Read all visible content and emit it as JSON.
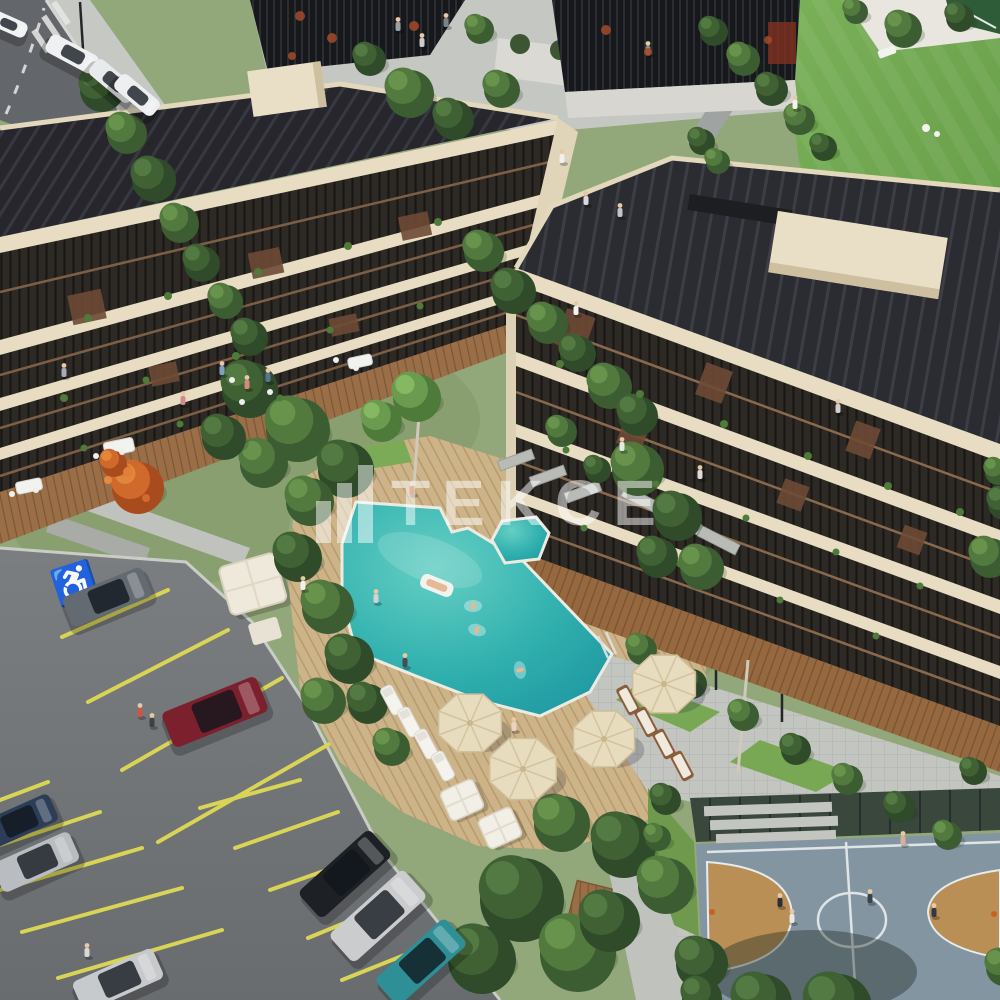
{
  "scene": {
    "type": "aerial-architectural-render",
    "subject": "residential complex with courtyard pool, parking lot and basketball court",
    "parking": {
      "accessible_symbol": "♿"
    }
  },
  "watermark": {
    "text": "TEKCE",
    "icon": "building-bars-logo",
    "color": "#ffffff",
    "opacity": 0.5
  },
  "palette": {
    "lawn": "#74a650",
    "garden": "#93a87a",
    "pool_main": "#35b5b2",
    "cream_band": "#e8ddc2",
    "roof_dark": "#26262c",
    "asphalt": "#77797c",
    "road": "#63666a",
    "deck_tan": "#cdb488",
    "terrace_wood": "#9a6f48",
    "court_blue": "#8495a2",
    "court_key_tan": "#b98f55",
    "stall_yellow": "#d9d455",
    "path_gray": "#c0c2bd",
    "tree_dark": "#3f6134",
    "tree_mid": "#527a3e",
    "tree_orange": "#cf6a2c"
  },
  "objects": {
    "trees": [
      [
        100,
        88,
        22,
        "d"
      ],
      [
        125,
        132,
        20,
        "m"
      ],
      [
        152,
        178,
        22,
        "d"
      ],
      [
        178,
        222,
        19,
        "m"
      ],
      [
        200,
        262,
        18,
        "d"
      ],
      [
        224,
        300,
        17,
        "m"
      ],
      [
        248,
        336,
        18,
        "d"
      ],
      [
        408,
        92,
        24,
        "m"
      ],
      [
        452,
        118,
        20,
        "d"
      ],
      [
        500,
        88,
        18,
        "m"
      ],
      [
        368,
        58,
        16,
        "d"
      ],
      [
        478,
        28,
        14,
        "m"
      ],
      [
        712,
        30,
        14,
        "d"
      ],
      [
        742,
        58,
        16,
        "m"
      ],
      [
        770,
        88,
        16,
        "d"
      ],
      [
        798,
        118,
        15,
        "m"
      ],
      [
        822,
        146,
        13,
        "d"
      ],
      [
        902,
        28,
        18,
        "m"
      ],
      [
        958,
        16,
        14,
        "d"
      ],
      [
        854,
        10,
        12,
        "m"
      ],
      [
        700,
        140,
        13,
        "d"
      ],
      [
        716,
        160,
        12,
        "m"
      ],
      [
        482,
        250,
        20,
        "m"
      ],
      [
        512,
        290,
        22,
        "d"
      ],
      [
        546,
        322,
        20,
        "m"
      ],
      [
        576,
        352,
        18,
        "d"
      ],
      [
        608,
        385,
        22,
        "m"
      ],
      [
        636,
        414,
        20,
        "d"
      ],
      [
        248,
        388,
        28,
        "d"
      ],
      [
        296,
        428,
        32,
        "m"
      ],
      [
        344,
        468,
        28,
        "d"
      ],
      [
        262,
        462,
        24,
        "m"
      ],
      [
        222,
        436,
        22,
        "d"
      ],
      [
        380,
        420,
        20,
        "l"
      ],
      [
        415,
        396,
        24,
        "l"
      ],
      [
        308,
        500,
        24,
        "m"
      ],
      [
        636,
        468,
        26,
        "m"
      ],
      [
        676,
        515,
        24,
        "d"
      ],
      [
        700,
        566,
        22,
        "m"
      ],
      [
        656,
        556,
        20,
        "d"
      ],
      [
        560,
        430,
        15,
        "m"
      ],
      [
        596,
        468,
        13,
        "d"
      ],
      [
        296,
        556,
        24,
        "d"
      ],
      [
        326,
        606,
        26,
        "m"
      ],
      [
        348,
        658,
        24,
        "d"
      ],
      [
        322,
        700,
        22,
        "m"
      ],
      [
        366,
        702,
        20,
        "d"
      ],
      [
        390,
        746,
        18,
        "m"
      ],
      [
        136,
        486,
        26,
        "o"
      ],
      [
        112,
        462,
        13,
        "o"
      ],
      [
        520,
        898,
        42,
        "d"
      ],
      [
        576,
        952,
        38,
        "m"
      ],
      [
        622,
        844,
        32,
        "d"
      ],
      [
        560,
        822,
        28,
        "m"
      ],
      [
        480,
        958,
        34,
        "d"
      ],
      [
        664,
        884,
        28,
        "m"
      ],
      [
        608,
        920,
        30,
        "d"
      ],
      [
        700,
        962,
        26,
        "d"
      ],
      [
        760,
        1002,
        30,
        "d"
      ],
      [
        836,
        1006,
        34,
        "d"
      ],
      [
        640,
        648,
        15,
        "m"
      ],
      [
        690,
        682,
        15,
        "d"
      ],
      [
        742,
        714,
        15,
        "m"
      ],
      [
        794,
        748,
        15,
        "d"
      ],
      [
        846,
        778,
        15,
        "m"
      ],
      [
        898,
        806,
        15,
        "d"
      ],
      [
        946,
        834,
        14,
        "m"
      ],
      [
        988,
        556,
        20,
        "m"
      ],
      [
        1002,
        502,
        16,
        "d"
      ],
      [
        996,
        470,
        13,
        "m"
      ],
      [
        664,
        798,
        15,
        "d"
      ],
      [
        656,
        836,
        13,
        "m"
      ],
      [
        700,
        996,
        20,
        "d"
      ],
      [
        972,
        770,
        13,
        "d"
      ],
      [
        1002,
        966,
        18,
        "m"
      ]
    ],
    "cars_road": [
      [
        72,
        54,
        28,
        54,
        20,
        "#eef0f1"
      ],
      [
        113,
        81,
        40,
        52,
        20,
        "#e8ebed"
      ],
      [
        137,
        95,
        40,
        50,
        19,
        "#edeff0"
      ],
      [
        8,
        24,
        24,
        40,
        16,
        "#f0f2f3"
      ]
    ],
    "cars_parking": [
      [
        107,
        597,
        -22,
        86,
        32,
        "#636a72"
      ],
      [
        215,
        712,
        -22,
        102,
        38,
        "#7c202e"
      ],
      [
        18,
        822,
        -24,
        78,
        30,
        "#2c3e57"
      ],
      [
        36,
        862,
        -24,
        84,
        32,
        "#b9bdc1"
      ],
      [
        118,
        980,
        -24,
        88,
        33,
        "#c7cacd"
      ],
      [
        345,
        874,
        -42,
        96,
        36,
        "#1d2125"
      ],
      [
        378,
        916,
        -42,
        100,
        38,
        "#caccce"
      ],
      [
        421,
        962,
        -42,
        94,
        36,
        "#2e8f96"
      ]
    ],
    "parking_lines": [
      [
        62,
        637,
        168,
        590
      ],
      [
        88,
        702,
        228,
        630
      ],
      [
        122,
        770,
        282,
        678
      ],
      [
        158,
        842,
        345,
        735
      ],
      [
        0,
        800,
        48,
        782
      ],
      [
        0,
        845,
        100,
        812
      ],
      [
        0,
        890,
        142,
        848
      ],
      [
        22,
        932,
        182,
        888
      ],
      [
        58,
        978,
        222,
        930
      ],
      [
        200,
        808,
        300,
        780
      ],
      [
        235,
        848,
        338,
        812
      ],
      [
        270,
        890,
        372,
        854
      ],
      [
        308,
        938,
        405,
        898
      ],
      [
        342,
        980,
        442,
        940
      ]
    ],
    "people": [
      [
        398,
        26,
        "#9aa0a6"
      ],
      [
        422,
        42,
        "#caccd0"
      ],
      [
        446,
        22,
        "#7d8288"
      ],
      [
        562,
        158,
        "#eef0f2"
      ],
      [
        586,
        200,
        "#d7d9da"
      ],
      [
        620,
        212,
        "#c2c6c9"
      ],
      [
        648,
        50,
        "#8b8f93"
      ],
      [
        795,
        104,
        "#f2f2ee"
      ],
      [
        183,
        400,
        "#d08b8b"
      ],
      [
        222,
        370,
        "#7fa0c0"
      ],
      [
        247,
        384,
        "#d88a7a"
      ],
      [
        268,
        377,
        "#5a7390"
      ],
      [
        412,
        490,
        "#c06a4a"
      ],
      [
        405,
        662,
        "#4a4a52"
      ],
      [
        514,
        726,
        "#e8d4c0"
      ],
      [
        376,
        598,
        "#d0d2d4"
      ],
      [
        140,
        712,
        "#cc5544"
      ],
      [
        152,
        722,
        "#3a4148"
      ],
      [
        303,
        585,
        "#f0f0ec"
      ],
      [
        87,
        952,
        "#d8d8d4"
      ],
      [
        780,
        902,
        "#2a3038"
      ],
      [
        792,
        918,
        "#e8e8e6"
      ],
      [
        903,
        840,
        "#d8b0a0"
      ],
      [
        934,
        912,
        "#2f3a44"
      ],
      [
        870,
        898,
        "#39424a"
      ],
      [
        576,
        310,
        "#f4f4f2"
      ],
      [
        622,
        446,
        "#e8e8e8"
      ],
      [
        700,
        474,
        "#dcdcdc"
      ],
      [
        838,
        408,
        "#d0d0cc"
      ],
      [
        64,
        372,
        "#a8aab8"
      ]
    ],
    "swimmers": [
      [
        473,
        606,
        0
      ],
      [
        477,
        630,
        15
      ],
      [
        520,
        670,
        80
      ]
    ],
    "umbrellas": [
      [
        470,
        723,
        34
      ],
      [
        523,
        769,
        36
      ],
      [
        604,
        739,
        33
      ],
      [
        664,
        684,
        34
      ]
    ],
    "loungers_white": [
      [
        392,
        700,
        -28
      ],
      [
        409,
        722,
        -28
      ],
      [
        426,
        744,
        -28
      ],
      [
        443,
        766,
        -28
      ]
    ],
    "loungers_wood": [
      [
        628,
        700,
        -28
      ],
      [
        646,
        722,
        -28
      ],
      [
        664,
        744,
        -28
      ],
      [
        682,
        766,
        -28
      ]
    ],
    "cabanas": [
      [
        462,
        800,
        -24
      ],
      [
        500,
        828,
        -24
      ]
    ],
    "dots": [
      [
        88,
        318,
        4,
        "#4e7a3a"
      ],
      [
        168,
        296,
        4,
        "#4e7a3a"
      ],
      [
        258,
        272,
        4,
        "#4e7a3a"
      ],
      [
        348,
        246,
        4,
        "#4e7a3a"
      ],
      [
        438,
        222,
        4,
        "#4e7a3a"
      ],
      [
        64,
        398,
        4,
        "#4e7a3a"
      ],
      [
        146,
        380,
        3.5,
        "#4e7a3a"
      ],
      [
        236,
        356,
        4,
        "#4e7a3a"
      ],
      [
        330,
        330,
        3.5,
        "#4e7a3a"
      ],
      [
        420,
        306,
        3.5,
        "#4e7a3a"
      ],
      [
        84,
        448,
        3.5,
        "#4e7a3a"
      ],
      [
        180,
        424,
        3.5,
        "#4e7a3a"
      ],
      [
        280,
        398,
        3.5,
        "#4e7a3a"
      ],
      [
        560,
        364,
        4,
        "#4e7a3a"
      ],
      [
        640,
        394,
        4,
        "#4e7a3a"
      ],
      [
        724,
        424,
        4,
        "#4e7a3a"
      ],
      [
        808,
        456,
        4,
        "#4e7a3a"
      ],
      [
        888,
        486,
        4,
        "#4e7a3a"
      ],
      [
        960,
        512,
        4,
        "#4e7a3a"
      ],
      [
        566,
        450,
        3.5,
        "#4e7a3a"
      ],
      [
        656,
        484,
        3.5,
        "#4e7a3a"
      ],
      [
        746,
        518,
        3.5,
        "#4e7a3a"
      ],
      [
        836,
        552,
        3.5,
        "#4e7a3a"
      ],
      [
        920,
        586,
        3.5,
        "#4e7a3a"
      ],
      [
        584,
        528,
        3.5,
        "#4e7a3a"
      ],
      [
        680,
        564,
        3.5,
        "#4e7a3a"
      ],
      [
        780,
        600,
        3.5,
        "#4e7a3a"
      ],
      [
        876,
        636,
        3.5,
        "#4e7a3a"
      ],
      [
        300,
        16,
        5,
        "#a34a28",
        0.85
      ],
      [
        332,
        38,
        5,
        "#a34a28",
        0.85
      ],
      [
        414,
        26,
        5,
        "#a34a28",
        0.85
      ],
      [
        292,
        56,
        4,
        "#a34a28",
        0.85
      ],
      [
        606,
        30,
        5,
        "#a34a28",
        0.85
      ],
      [
        648,
        52,
        4,
        "#a34a28",
        0.85
      ],
      [
        768,
        40,
        4,
        "#a34a28",
        0.85
      ],
      [
        96,
        456,
        3,
        "#eef0ee"
      ],
      [
        122,
        452,
        3,
        "#eef0ee"
      ],
      [
        12,
        494,
        3,
        "#eef0ee"
      ],
      [
        36,
        490,
        3,
        "#eef0ee"
      ],
      [
        242,
        402,
        3,
        "#eef0ee"
      ],
      [
        232,
        380,
        3,
        "#eef0ee"
      ],
      [
        270,
        392,
        3,
        "#eef0ee"
      ],
      [
        356,
        368,
        3,
        "#eef0ee"
      ],
      [
        336,
        360,
        3,
        "#eef0ee"
      ],
      [
        926,
        128,
        4,
        "#f2f2ef"
      ],
      [
        937,
        134,
        3,
        "#f2f2ef"
      ],
      [
        128,
        472,
        5,
        "#e07f3a"
      ],
      [
        146,
        498,
        4,
        "#d2692e"
      ],
      [
        108,
        480,
        4,
        "#e8883e"
      ],
      [
        712,
        912,
        3,
        "#c9611f"
      ],
      [
        994,
        914,
        3,
        "#c9611f"
      ]
    ]
  }
}
